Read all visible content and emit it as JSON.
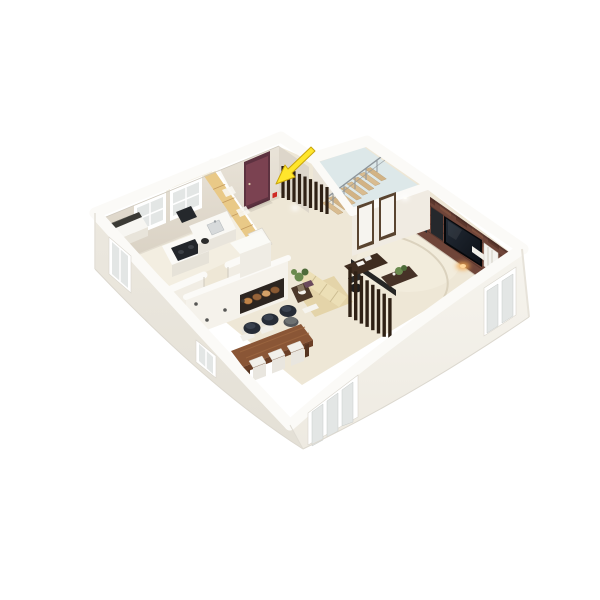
{
  "scene": {
    "type": "3d-floor-plan-render",
    "description": "Isometric 3D cutaway floor plan of an apartment on a white background. White exterior walls with windows. Rooms: kitchen with island and wood cabinets (top left), entry hall with dark maroon front door marked by a yellow arrow, stairwell with wooden staircase and metal railing, open living-dining room with dining table, pendant lamps, beige sofa, desk behind wood-slat partition, and a brick accent wall with wall-mounted TV.",
    "annotation": {
      "name": "direction-arrow",
      "shape": "yellow arrow",
      "points_at": "entrance-door",
      "color": "#ffe62c"
    }
  },
  "rooms": [
    {
      "id": "kitchen",
      "label": "Kitchen",
      "position": "top-left"
    },
    {
      "id": "entry-hall",
      "label": "Entry hall",
      "position": "top-center",
      "feature": "maroon front door indicated by yellow arrow"
    },
    {
      "id": "stairwell",
      "label": "Stairwell",
      "position": "top-center-right",
      "feature": "wooden stairs with metal railing, pale blue floor"
    },
    {
      "id": "living-room",
      "label": "Living room",
      "position": "right",
      "feature": "brick accent wall with TV, two interior doors"
    },
    {
      "id": "dining-area",
      "label": "Dining area",
      "position": "bottom-center",
      "feature": "wood table, white chairs, three black pendant lamps"
    }
  ],
  "furniture": [
    {
      "room": "kitchen",
      "items": [
        "kitchen-island-cooktop",
        "kitchen-island-sink",
        "range-hood",
        "wood-cabinet-run",
        "fridge",
        "bar-stool",
        "back-counter",
        "two-back-windows"
      ]
    },
    {
      "room": "entry-hall",
      "items": [
        "entrance-door",
        "wood-slat-screen",
        "wall-sconce",
        "alarm-box"
      ]
    },
    {
      "room": "stairwell",
      "items": [
        "staircase",
        "stair-railing",
        "interior-door-1",
        "interior-door-2"
      ]
    },
    {
      "room": "living-room",
      "items": [
        "sofa",
        "cushion",
        "side-table",
        "ottoman",
        "desk",
        "office-chair",
        "slat-partition",
        "tv",
        "speakers",
        "radiator",
        "media-shelf",
        "plants",
        "rug"
      ]
    },
    {
      "room": "dining-area",
      "items": [
        "dining-table",
        "dining-chairs",
        "pendant-lamps",
        "fireplace-divider",
        "firewood-niche"
      ]
    }
  ],
  "exterior": {
    "windows": [
      "left-wall-window",
      "front-left-window",
      "front-triple-window",
      "front-right-double-window"
    ],
    "wall_finish": "white plaster, cut-away top edges shown as white bands"
  },
  "colors": {
    "bg": "#ffffff",
    "wall_top": "#fbfaf7",
    "wall_outer_left": "#e8e4db",
    "wall_outer_front": "#f3f0e9",
    "wall_inner": "#e3dcd0",
    "floor_main": "#eee7d6",
    "floor_kitchen": "#f3eee1",
    "floor_stairwell": "#dde8e9",
    "brick_base": "#6f4539",
    "brick_light": "#82523f",
    "brick_dark": "#5a352b",
    "entrance_door": "#7b4251",
    "slat_wood": "#2f2115",
    "cabinet_wood": "#e9c987",
    "stair_wood": "#d9bc90",
    "table_wood": "#8a5636",
    "sofa_beige": "#e4d4a9",
    "tv_screen": "#151a21",
    "fixture_dark": "#25282c",
    "window_glass": "#e3e6e5",
    "window_frame": "#ffffff",
    "plant_green": "#6a8a4e",
    "arrow_yellow": "#ffe62c",
    "arrow_outline": "#c9a50b",
    "accent_warm_light": "#f3a94f"
  }
}
